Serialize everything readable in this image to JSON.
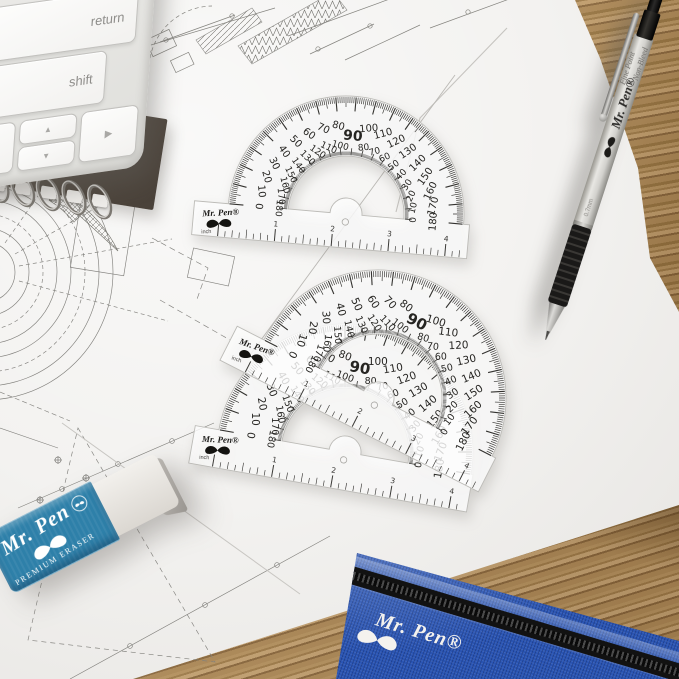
{
  "keyboard": {
    "return_label": "return",
    "shift_label": "shift",
    "arrow_up": "▲",
    "arrow_down": "▼",
    "arrow_right": "▶"
  },
  "protractor": {
    "brand": "Mr. Pen®",
    "unit": "inch",
    "outer_scale": [
      0,
      10,
      20,
      30,
      40,
      50,
      60,
      70,
      80,
      90,
      100,
      110,
      120,
      130,
      140,
      150,
      160,
      170,
      180
    ],
    "inner_scale": [
      180,
      170,
      160,
      150,
      140,
      130,
      120,
      110,
      100,
      90,
      80,
      70,
      60,
      50,
      40,
      30,
      20,
      10,
      0
    ],
    "ruler_numbers": [
      1,
      2,
      3,
      4
    ]
  },
  "pen": {
    "brand": "Mr. Pen®",
    "feature_line1": "Non-Bleed",
    "feature_line2": "Fine Point",
    "tip_size": "0.7mm"
  },
  "eraser": {
    "brand": "Mr. Pen",
    "product": "PREMIUM ERASER"
  },
  "pouch": {
    "brand": "Mr. Pen®"
  },
  "colors": {
    "eraser_blue": "#2e80a9",
    "pouch_blue": "#2a55b4",
    "zipper_black": "#121212",
    "pen_grip_black": "#1a1918",
    "paper": "#f3f2f0",
    "wood": "#a98655",
    "plastic_tick": "#33322f"
  }
}
